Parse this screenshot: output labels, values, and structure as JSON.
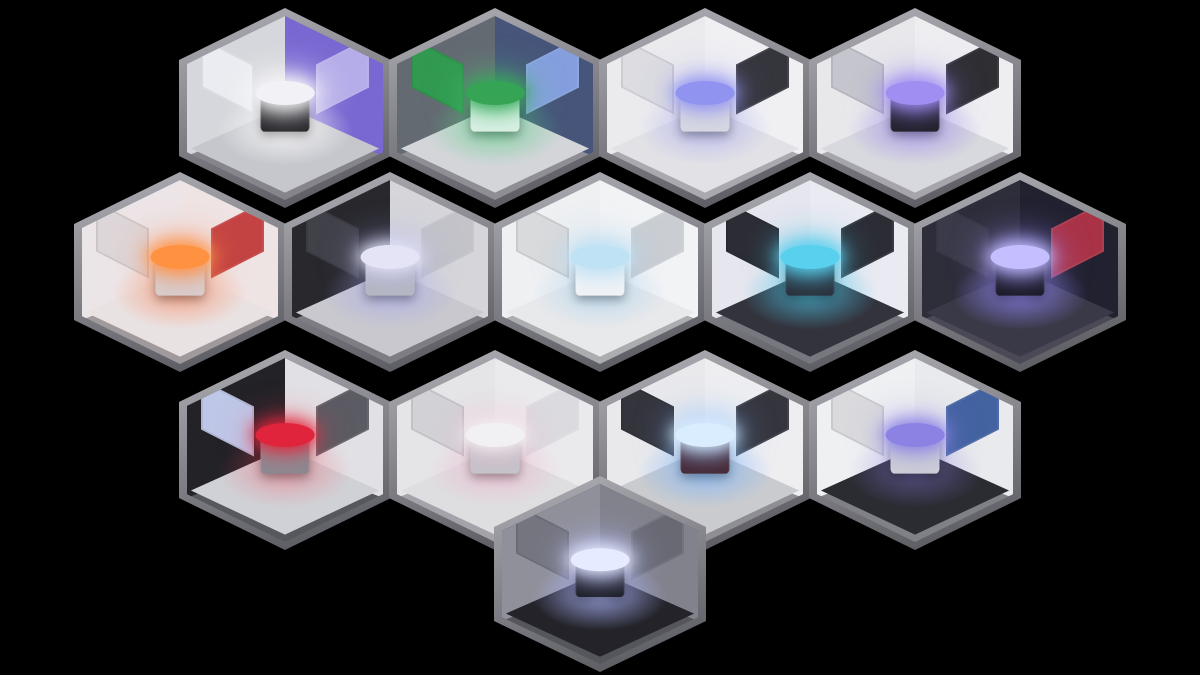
{
  "scene": {
    "background": "#000000",
    "hex_border": "#8a8a90",
    "grid": {
      "rows": [
        4,
        5,
        4,
        1
      ],
      "total_rooms": 14
    }
  },
  "rooms": [
    {
      "name": "satellite-control-room",
      "feature": "holo-ring-display",
      "colors": {
        "wall_left": "#d6d7dc",
        "wall_right": "#7a68d2",
        "floor": "#c6c7cd",
        "ledge": "#85858b",
        "glow": "rgba(255,255,255,0.80)",
        "object": "#1b1b20",
        "object_top": "#f2f2f6",
        "panel_left": "#eceef2",
        "panel_right": "#b9b2ea"
      }
    },
    {
      "name": "specimen-lab",
      "feature": "specimen-pod",
      "colors": {
        "wall_left": "#646a72",
        "wall_right": "#47557a",
        "floor": "#d3d5d9",
        "ledge": "#8e8e94",
        "glow": "rgba(80,210,130,0.55)",
        "object": "#dff0e8",
        "object_top": "#35a455",
        "panel_left": "#2f9e4f",
        "panel_right": "#8aa4e4"
      }
    },
    {
      "name": "clean-lab",
      "feature": "glass-dome-machine",
      "colors": {
        "wall_left": "#ebebee",
        "wall_right": "#f0f0f3",
        "floor": "#e2e2e6",
        "ledge": "#a9a9af",
        "glow": "rgba(150,150,245,0.45)",
        "object": "#d9dae0",
        "object_top": "#9193f0",
        "panel_left": "#dcdce0",
        "panel_right": "#2b2b32"
      }
    },
    {
      "name": "briefing-room",
      "feature": "holo-globe-table",
      "colors": {
        "wall_left": "#e8e8eb",
        "wall_right": "#eeeef1",
        "floor": "#d8d9de",
        "ledge": "#a5a5ab",
        "glow": "rgba(150,128,240,0.60)",
        "object": "#1d1d23",
        "object_top": "#a18ef2",
        "panel_left": "#c3c4cc",
        "panel_right": "#232329"
      }
    },
    {
      "name": "laser-lab",
      "feature": "laser-emitter",
      "colors": {
        "wall_left": "#ece5e7",
        "wall_right": "#efe4e4",
        "floor": "#e9e2e3",
        "ledge": "#a09a9c",
        "glow": "rgba(255,130,80,0.55)",
        "object": "#d6d0d2",
        "object_top": "#ff9240",
        "panel_left": "#ddd5d7",
        "panel_right": "#c03a3a"
      }
    },
    {
      "name": "robotics-bay",
      "feature": "robot-arm-platform",
      "colors": {
        "wall_left": "#28282d",
        "wall_right": "#d5d5da",
        "floor": "#c8c8ce",
        "ledge": "#7d7d83",
        "glow": "rgba(165,165,248,0.50)",
        "object": "#b7b8c0",
        "object_top": "#e4e4f6",
        "panel_left": "#43434b",
        "panel_right": "#c2c2c9"
      }
    },
    {
      "name": "med-bay",
      "feature": "med-bed",
      "colors": {
        "wall_left": "#eef0f2",
        "wall_right": "#f2f3f5",
        "floor": "#e8e9eb",
        "ledge": "#abadaf",
        "glow": "rgba(140,200,240,0.40)",
        "object": "#f5f5f7",
        "object_top": "#bfe2f5",
        "panel_left": "#d7d9db",
        "panel_right": "#c8ccd1"
      }
    },
    {
      "name": "server-room",
      "feature": "holo-circuit-table",
      "colors": {
        "wall_left": "#e6e6ee",
        "wall_right": "#eaeaf2",
        "floor": "#33333c",
        "ledge": "#77777f",
        "glow": "rgba(80,200,235,0.70)",
        "object": "#292932",
        "object_top": "#58d0ee",
        "panel_left": "#22222a",
        "panel_right": "#22222a"
      }
    },
    {
      "name": "tesla-chamber",
      "feature": "tesla-platform",
      "colors": {
        "wall_left": "#2e2d3a",
        "wall_right": "#222130",
        "floor": "#3a3948",
        "ledge": "#4a4955",
        "glow": "rgba(150,140,255,0.75)",
        "object": "#14141a",
        "object_top": "#c6bfff",
        "panel_left": "#3d3c4a",
        "panel_right": "#b23448"
      }
    },
    {
      "name": "engine-room",
      "feature": "engine-sphere",
      "colors": {
        "wall_left": "#222227",
        "wall_right": "#e1e1e5",
        "floor": "#d0d1d6",
        "ledge": "#57575e",
        "glow": "rgba(255,70,90,0.35)",
        "object": "#8a8a92",
        "object_top": "#e0243c",
        "panel_left": "#c8d1f2",
        "panel_right": "#54545c"
      }
    },
    {
      "name": "calibration-bay",
      "feature": "suspended-ring",
      "colors": {
        "wall_left": "#e5e5e8",
        "wall_right": "#eaeaed",
        "floor": "#dedee1",
        "ledge": "#a3a3a9",
        "glow": "rgba(255,150,190,0.35)",
        "object": "#c4c5cb",
        "object_top": "#f1f1f4",
        "panel_left": "#d1d1d5",
        "panel_right": "#dbdbdf"
      }
    },
    {
      "name": "containment-chamber",
      "feature": "plasma-orb-machine",
      "colors": {
        "wall_left": "#e9e9ec",
        "wall_right": "#eeeef1",
        "floor": "#c9cbcf",
        "ledge": "#8e8e94",
        "glow": "rgba(120,180,255,0.65)",
        "object": "#45232b",
        "object_top": "#d9edff",
        "panel_left": "#2b2b33",
        "panel_right": "#2b2b33"
      }
    },
    {
      "name": "accelerator-room",
      "feature": "coil-accelerator",
      "colors": {
        "wall_left": "#eff0f2",
        "wall_right": "#e9eaed",
        "floor": "#2b2b32",
        "ledge": "#808088",
        "glow": "rgba(140,130,230,0.45)",
        "object": "#ced0d6",
        "object_top": "#8b82e4",
        "panel_left": "#d8d8dc",
        "panel_right": "#3a5b9c"
      }
    },
    {
      "name": "reactor-core",
      "feature": "reactor-coil",
      "colors": {
        "wall_left": "#90909a",
        "wall_right": "#82828c",
        "floor": "#232329",
        "ledge": "#55555e",
        "glow": "rgba(175,185,255,0.80)",
        "object": "#16161c",
        "object_top": "#e6ebff",
        "panel_left": "#74747e",
        "panel_right": "#686872"
      }
    }
  ]
}
